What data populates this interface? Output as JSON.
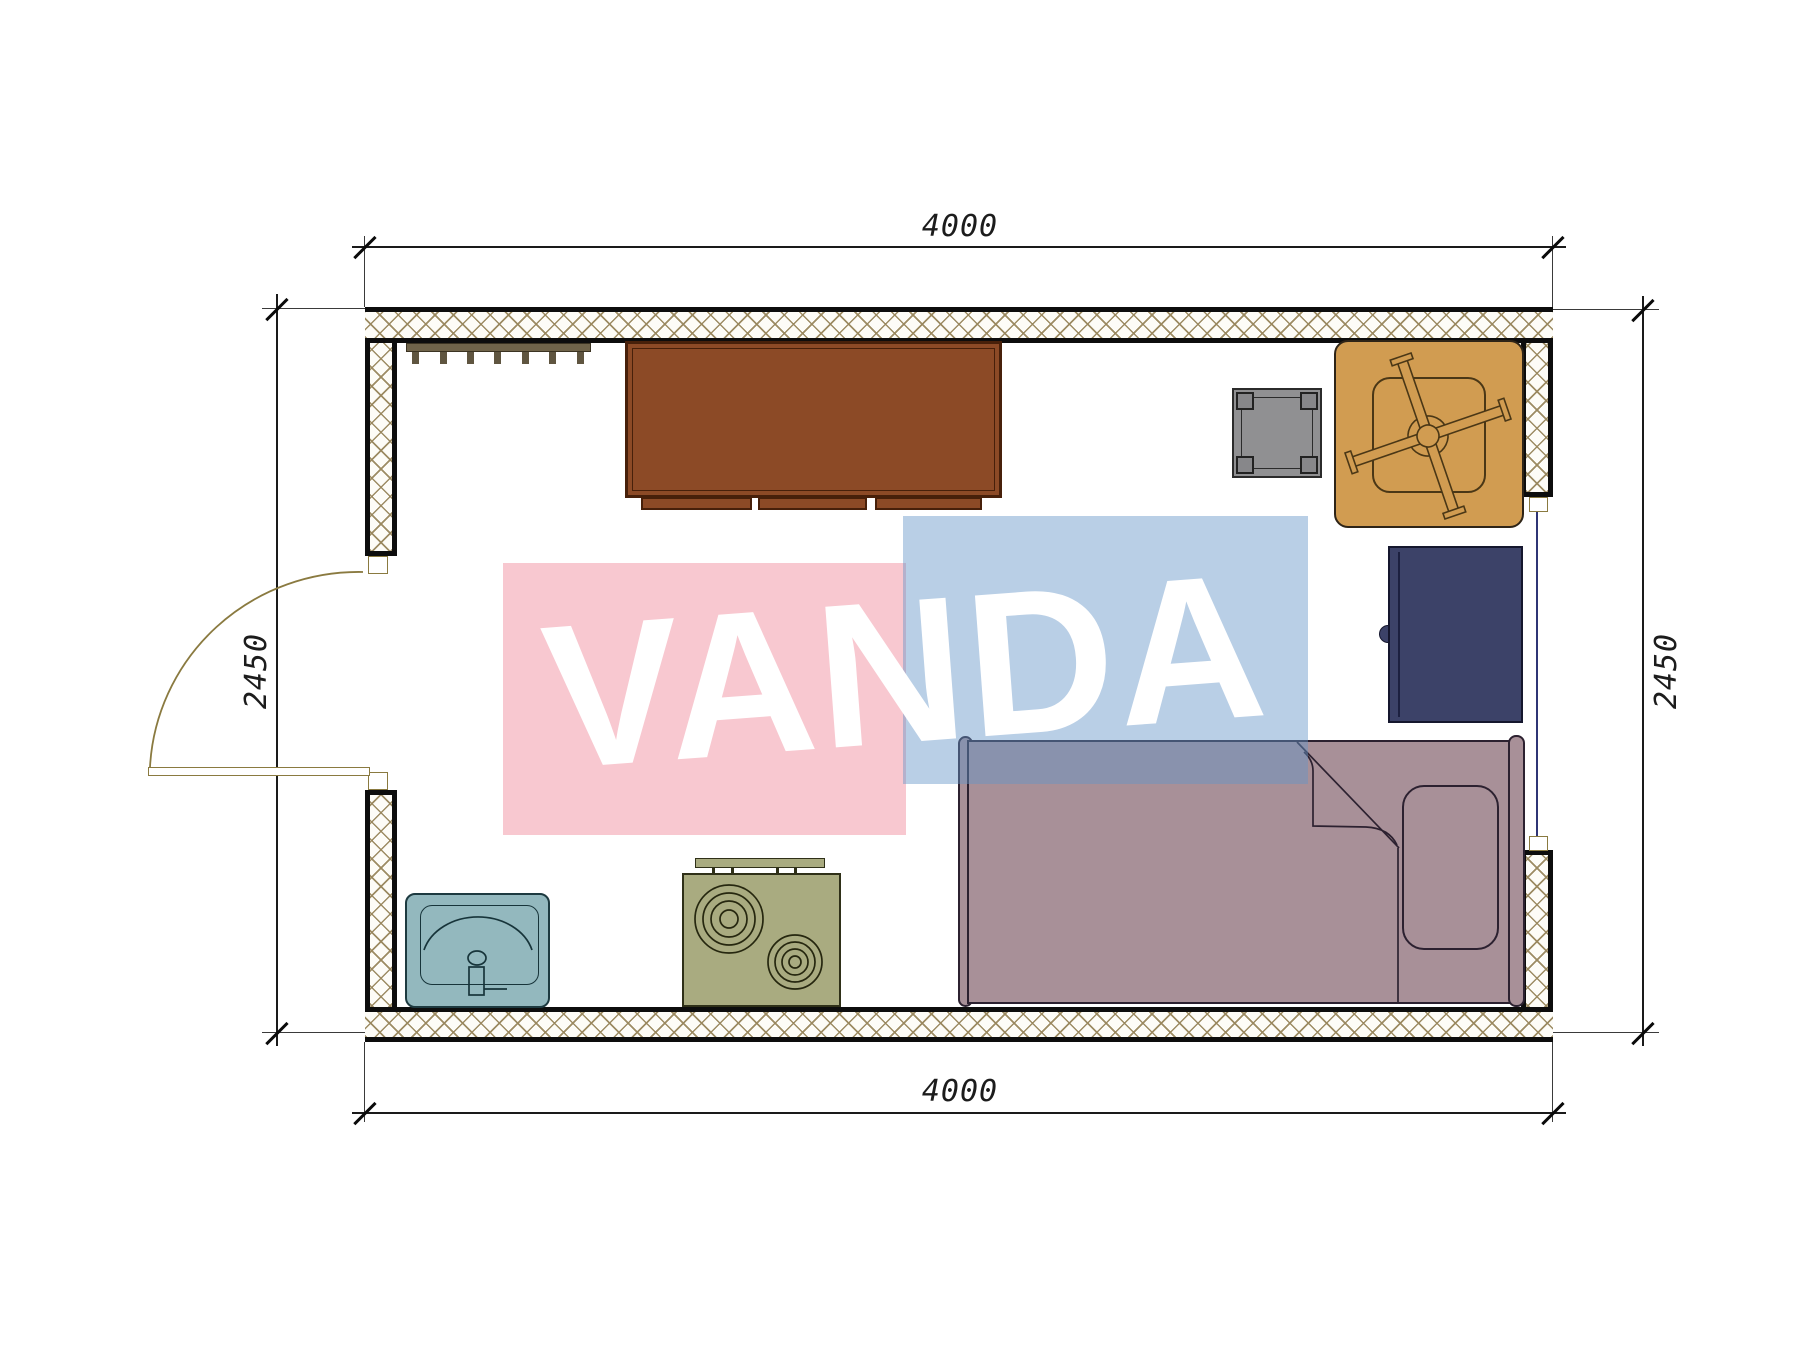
{
  "watermark": {
    "text": "VANDA",
    "pink_color": "#f8c8d0",
    "blue_color": "rgba(100,148,200,0.45)",
    "text_color": "#ffffff"
  },
  "dimensions": {
    "top_width": "4000",
    "bottom_width": "4000",
    "left_height": "2450",
    "right_height": "2450"
  },
  "plan": {
    "wall_hatch_color": "#98865c",
    "wall_line_color": "#0d0d0d",
    "door_color": "#8a7a40",
    "window_color": "#2f3575",
    "furniture": [
      {
        "name": "coat-rack",
        "color": "#70644a"
      },
      {
        "name": "desk",
        "color": "#8c4a26"
      },
      {
        "name": "side-table",
        "color": "#909092"
      },
      {
        "name": "office-chair",
        "color": "#d19c51"
      },
      {
        "name": "wardrobe",
        "color": "#3c4268"
      },
      {
        "name": "bed",
        "color": "#a89098"
      },
      {
        "name": "sink",
        "color": "#93b8be"
      },
      {
        "name": "stove",
        "color": "#a9ab80"
      }
    ]
  }
}
